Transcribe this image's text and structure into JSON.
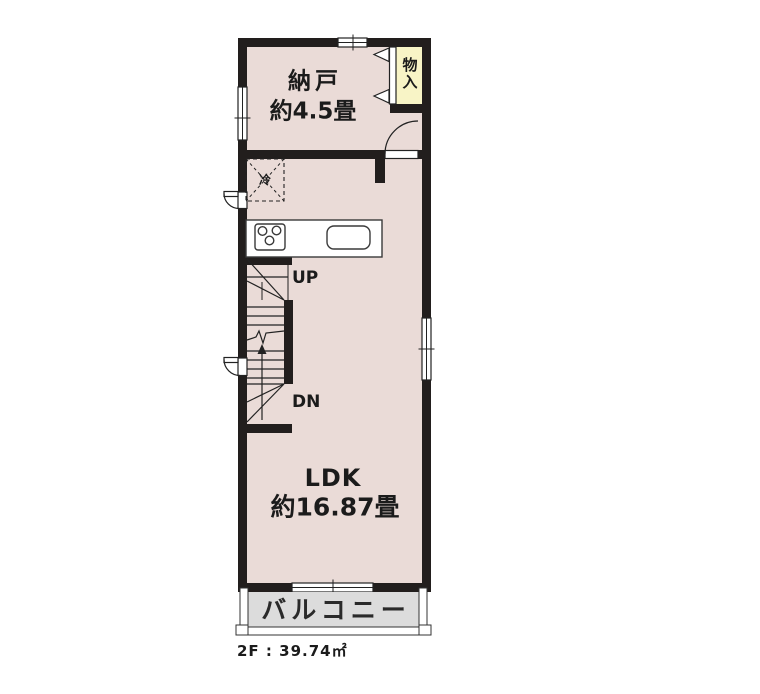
{
  "floor_plan": {
    "rooms": {
      "storage": {
        "name": "納戸",
        "size": "約4.5畳"
      },
      "ldk": {
        "name": "LDK",
        "size": "約16.87畳"
      },
      "closet": {
        "name": "物入"
      },
      "balcony": {
        "name": "バルコニー"
      }
    },
    "labels": {
      "refrigerator": "冷",
      "stairs_up": "UP",
      "stairs_down": "DN"
    },
    "footer": {
      "floor_area": "2F : 39.74㎡"
    },
    "colors": {
      "background": "#FFFFFF",
      "room_fill": "#EADBD7",
      "closet_fill": "#F8F4C6",
      "balcony_fill": "#DCDCDC",
      "wall": "#221E1D",
      "line": "#222222"
    }
  }
}
